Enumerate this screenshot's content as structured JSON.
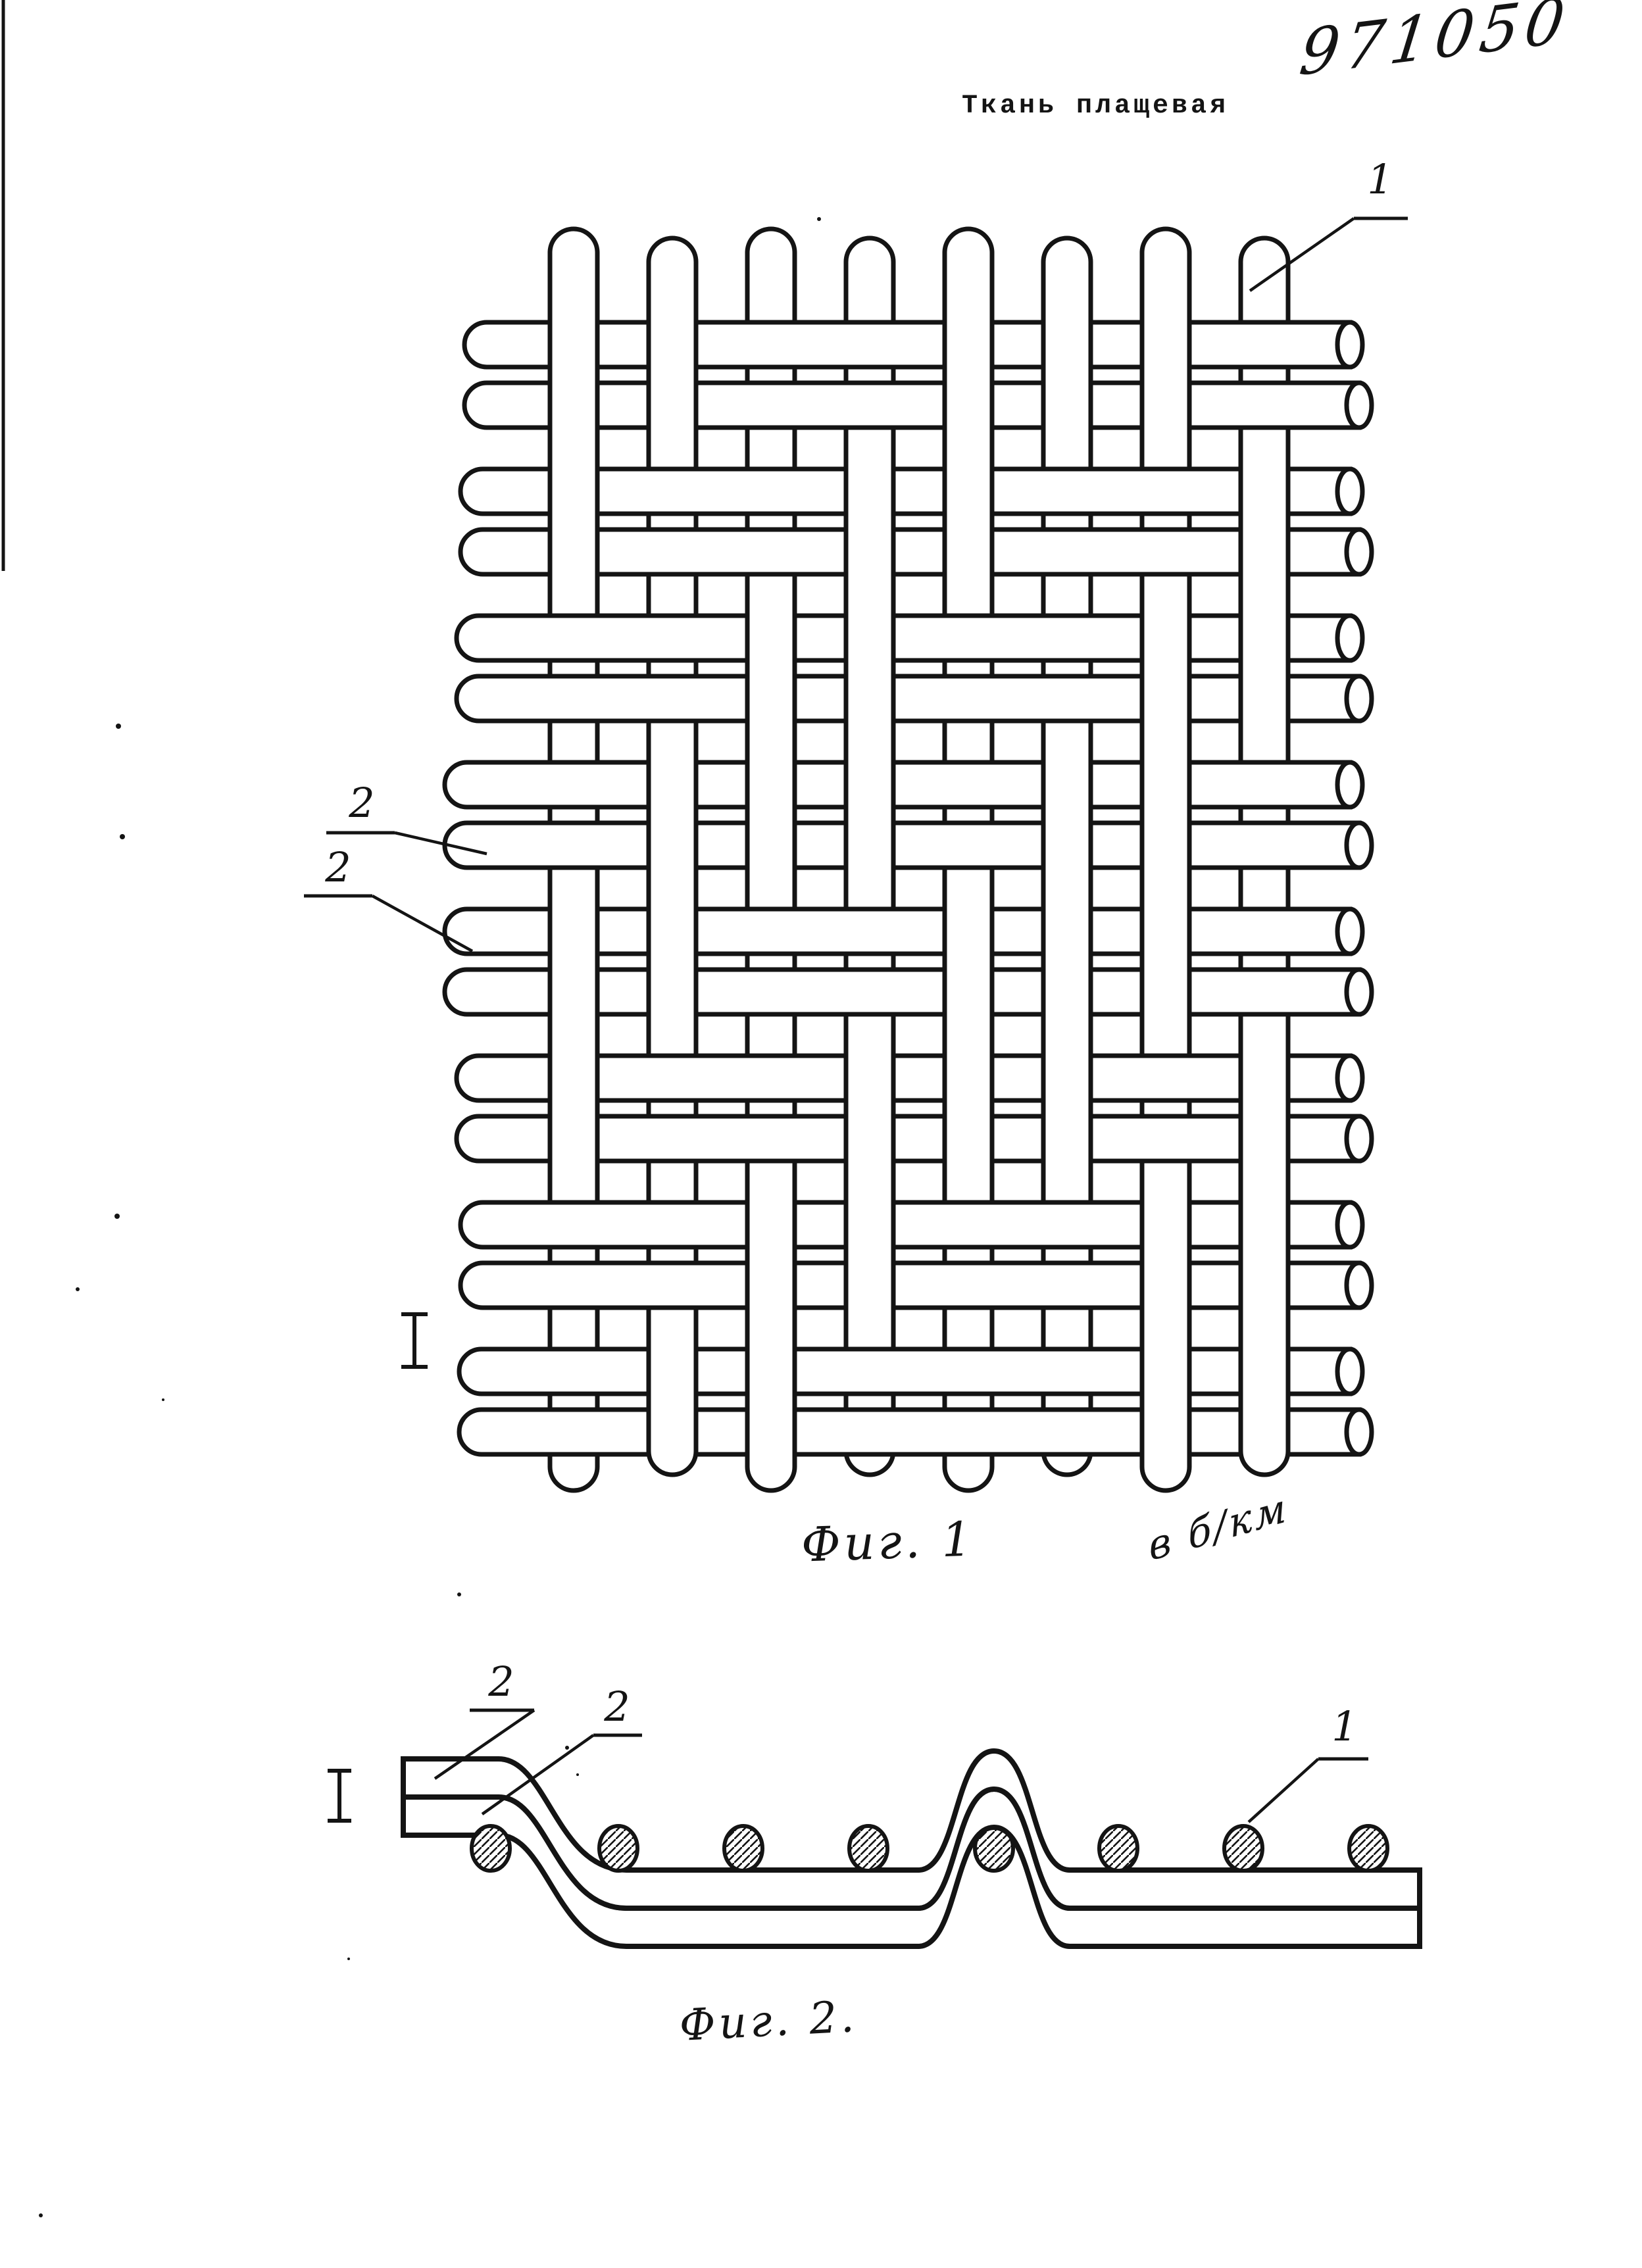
{
  "page": {
    "title": "Ткань плащевая",
    "patent_number": "971050",
    "ink_color": "#141414",
    "paper_color": "#ffffff"
  },
  "figure1": {
    "caption": "Фиг. 1",
    "handwritten_note": "в б/км",
    "section_marker": "I",
    "labels": {
      "warp": "1",
      "weft_upper": "2",
      "weft_lower": "2"
    },
    "weave": {
      "warp_thread_count": 8,
      "weft_pair_count": 8,
      "wefts_per_pair": 2,
      "warp_over_weft_pair_matrix": [
        [
          1,
          1,
          0,
          0,
          1,
          1,
          1,
          0
        ],
        [
          1,
          0,
          0,
          1,
          1,
          0,
          0,
          1
        ],
        [
          0,
          0,
          1,
          1,
          0,
          0,
          1,
          1
        ],
        [
          0,
          1,
          1,
          1,
          0,
          1,
          1,
          0
        ],
        [
          1,
          1,
          0,
          0,
          1,
          1,
          1,
          0
        ],
        [
          1,
          0,
          0,
          1,
          1,
          1,
          0,
          1
        ],
        [
          0,
          0,
          1,
          1,
          0,
          0,
          1,
          1
        ],
        [
          0,
          1,
          1,
          0,
          0,
          0,
          1,
          1
        ]
      ]
    }
  },
  "figure2": {
    "caption": "Фиг. 2.",
    "section_marker": "I",
    "labels": {
      "weft_upper": "2",
      "weft_lower": "2",
      "warp": "1"
    },
    "warp_cross_section_count": 8,
    "weft_layer_count": 2
  }
}
